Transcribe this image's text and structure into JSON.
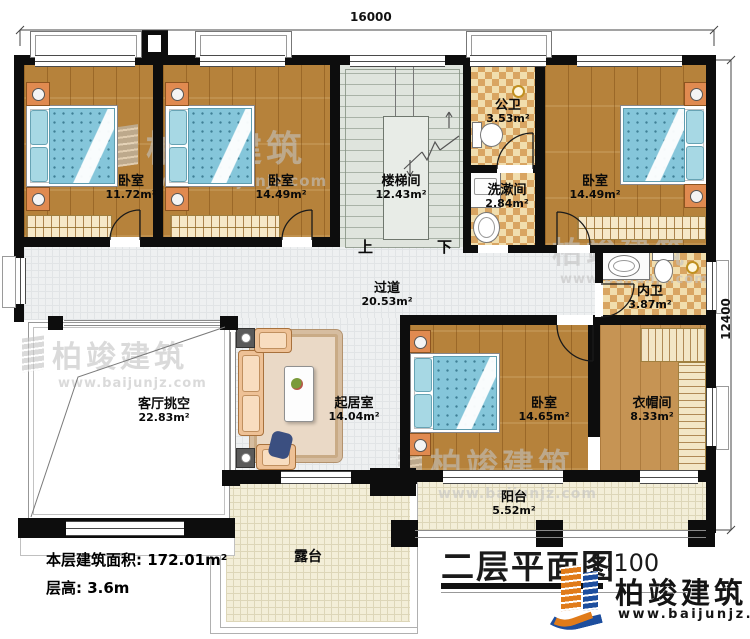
{
  "dimensions": {
    "top": "16000",
    "right": "12400"
  },
  "rooms": [
    {
      "id": "bedroom-top-left",
      "name": "卧室",
      "area": "11.72m²"
    },
    {
      "id": "bedroom-top-mid",
      "name": "卧室",
      "area": "14.49m²"
    },
    {
      "id": "stairwell",
      "name": "楼梯间",
      "area": "12.43m²"
    },
    {
      "id": "public-bath",
      "name": "公卫",
      "area": "3.53m²"
    },
    {
      "id": "washroom",
      "name": "洗漱间",
      "area": "2.84m²"
    },
    {
      "id": "bedroom-top-right",
      "name": "卧室",
      "area": "14.49m²"
    },
    {
      "id": "ensuite-bath",
      "name": "内卫",
      "area": "3.87m²"
    },
    {
      "id": "corridor",
      "name": "过道",
      "area": "20.53m²"
    },
    {
      "id": "living-void",
      "name": "客厅挑空",
      "area": "22.83m²"
    },
    {
      "id": "family-room",
      "name": "起居室",
      "area": "14.04m²"
    },
    {
      "id": "bedroom-bottom",
      "name": "卧室",
      "area": "14.65m²"
    },
    {
      "id": "cloakroom",
      "name": "衣帽间",
      "area": "8.33m²"
    },
    {
      "id": "balcony",
      "name": "阳台",
      "area": "5.52m²"
    },
    {
      "id": "terrace",
      "name": "露台",
      "area": ""
    }
  ],
  "stairs": {
    "up": "上",
    "down": "下"
  },
  "info": {
    "floor_area": "本层建筑面积: 172.01m²",
    "floor_height": "层高: 3.6m"
  },
  "titleblock": {
    "title": "二层平面图",
    "scale": "1:100"
  },
  "brand": {
    "name": "柏竣建筑",
    "url": "www.baijunjz.com"
  },
  "watermark": {
    "name": "柏竣建筑",
    "url": "www.baijunjz.com"
  },
  "colors": {
    "wall": "#0d0d0d",
    "wood": "#b6823b",
    "bath_tile": "#d9a562",
    "bedding": "#85c6da",
    "brand_blue": "#1d4e9e",
    "brand_orange": "#e07b1a"
  }
}
